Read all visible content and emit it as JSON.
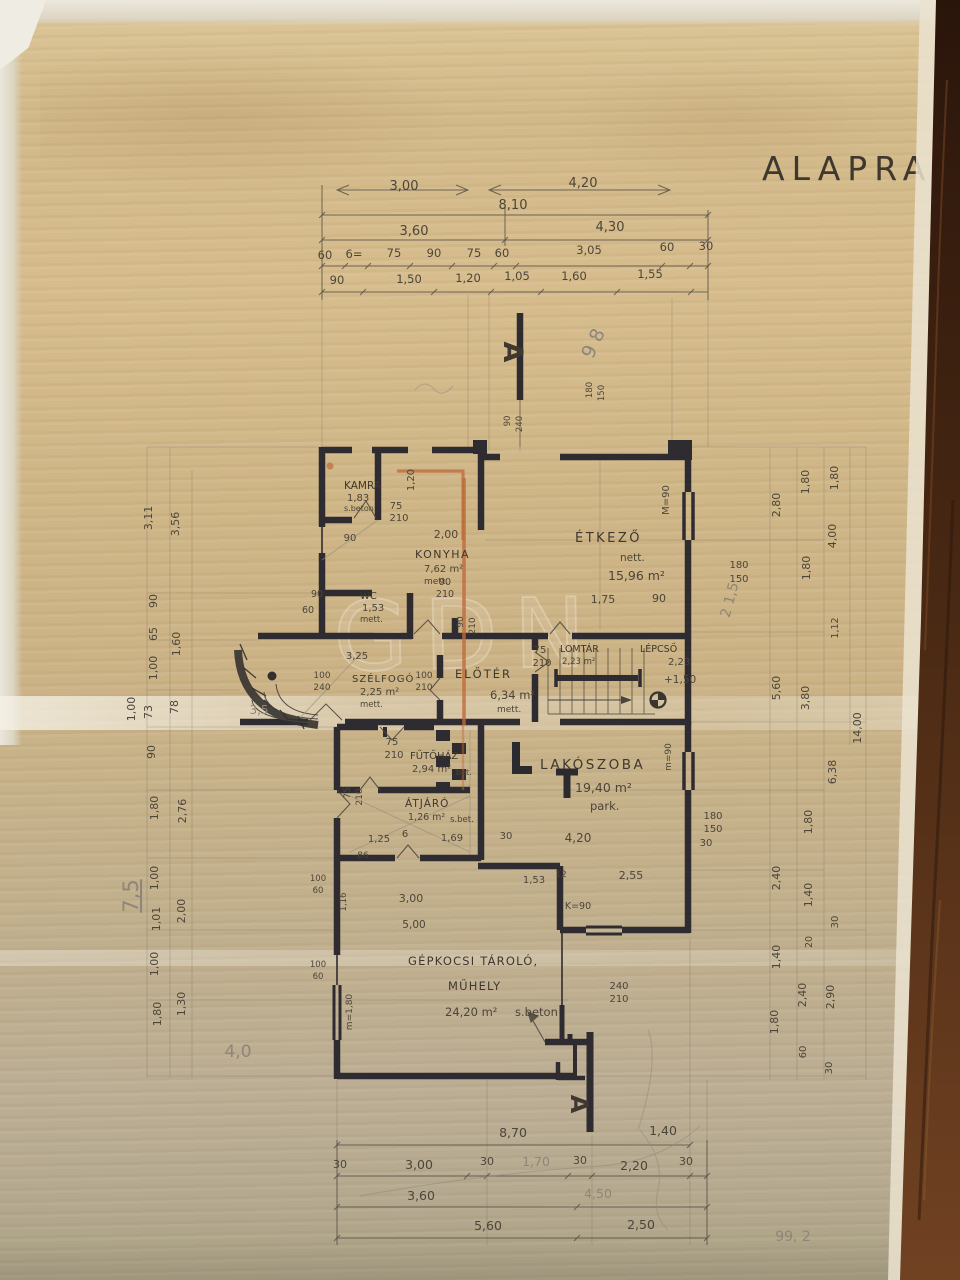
{
  "document": {
    "title": "ALAPRA",
    "type_note": "scanned hand-drawn floor plan",
    "watermark": "GDN",
    "page_note": "99, 2",
    "colors": {
      "paper": "#cfb687",
      "ink": "#4c453a",
      "wall": "#2e2c31",
      "pencil": "#8e867a",
      "red_pencil": "#bf6a3a",
      "table_leather": "#3e2312"
    }
  },
  "sections": {
    "top": "A",
    "bottom": "A"
  },
  "rooms": {
    "kamra": {
      "name": "KAMRA",
      "area": "1,83",
      "note": "s.beton"
    },
    "konyha": {
      "name": "KONYHA",
      "area": "7,62 m²",
      "note": "mett."
    },
    "etkezo": {
      "name": "ÉTKEZŐ",
      "note": "nett.",
      "area": "15,96 m²"
    },
    "wc": {
      "name": "WC",
      "area": "1,53",
      "note": "mett."
    },
    "szelfogo": {
      "name": "SZÉLFOGÓ",
      "area": "2,25 m²",
      "note": "mett."
    },
    "eloter": {
      "name": "ELŐTÉR",
      "area": "6,34 m²",
      "note": "mett."
    },
    "lomtar": {
      "name": "LOMTÁR",
      "area": "2,23 m²"
    },
    "lepcso": {
      "name": "LÉPCSŐ",
      "area": "2,23",
      "level": "+1,50"
    },
    "futohaz": {
      "name": "FŰTŐHÁZ",
      "area": "2,94 m²",
      "note": "bet."
    },
    "atjaro": {
      "name": "ÁTJÁRÓ",
      "area": "1,26 m²",
      "note": "s.bet."
    },
    "lakoszoba": {
      "name": "LAKÓSZOBA",
      "area": "19,40 m²",
      "note": "park."
    },
    "garazs": {
      "name": "GÉPKOCSI TÁROLÓ,",
      "name2": "MŰHELY",
      "area": "24,20 m²",
      "note": "s.beton"
    }
  },
  "dims": {
    "top": [
      "3,00",
      "4,20",
      "8,10",
      "3,60",
      "4,30",
      "60",
      "6=",
      "75",
      "90",
      "75",
      "60",
      "3,05",
      "60",
      "30",
      "90",
      "1,50",
      "1,20",
      "1,05",
      "1,60",
      "1,55"
    ],
    "bottom": [
      "8,70",
      "30",
      "3,00",
      "30",
      "1,70",
      "30",
      "2,20",
      "30",
      "3,60",
      "4,50",
      "5,60",
      "2,50",
      "1,40"
    ],
    "left": [
      "3,11",
      "3,56",
      "90",
      "65",
      "1,00",
      "1,60",
      "73",
      "78",
      "1,00",
      "90",
      "1,80",
      "2,76",
      "1,00",
      "1,01",
      "2,00",
      "1,00",
      "1,30",
      "1,80"
    ],
    "right": [
      "2,80",
      "1,80",
      "1,80",
      "4,00",
      "1,80",
      "1,12",
      "5,60",
      "3,80",
      "14,00",
      "6,38",
      "1,80",
      "2,40",
      "1,40",
      "30",
      "20",
      "1,40",
      "2,40",
      "2,90",
      "1,80",
      "60",
      "30"
    ],
    "inner": [
      "75",
      "210",
      "1,20",
      "90",
      "2,00",
      "90",
      "210",
      "90",
      "210",
      "90",
      "60",
      "1,75",
      "90",
      "M=90",
      "180",
      "150",
      "3,25",
      "100",
      "240",
      "100",
      "210",
      "75",
      "210",
      "75",
      "210",
      "75",
      "210",
      "1,25",
      "6",
      "1,69",
      "30",
      "86",
      "4,20",
      "180",
      "150",
      "30",
      "m=90",
      "1,53",
      "12",
      "2,55",
      "K=90",
      "3,00",
      "5,00",
      "100",
      "60",
      "1,16",
      "100",
      "60",
      "m=1,80",
      "240",
      "210",
      "180",
      "150",
      "90",
      "240"
    ]
  },
  "pencil_notes": [
    "9 8",
    "2 1,5",
    "3,5",
    "7,5",
    "4,0",
    "99, 2"
  ]
}
